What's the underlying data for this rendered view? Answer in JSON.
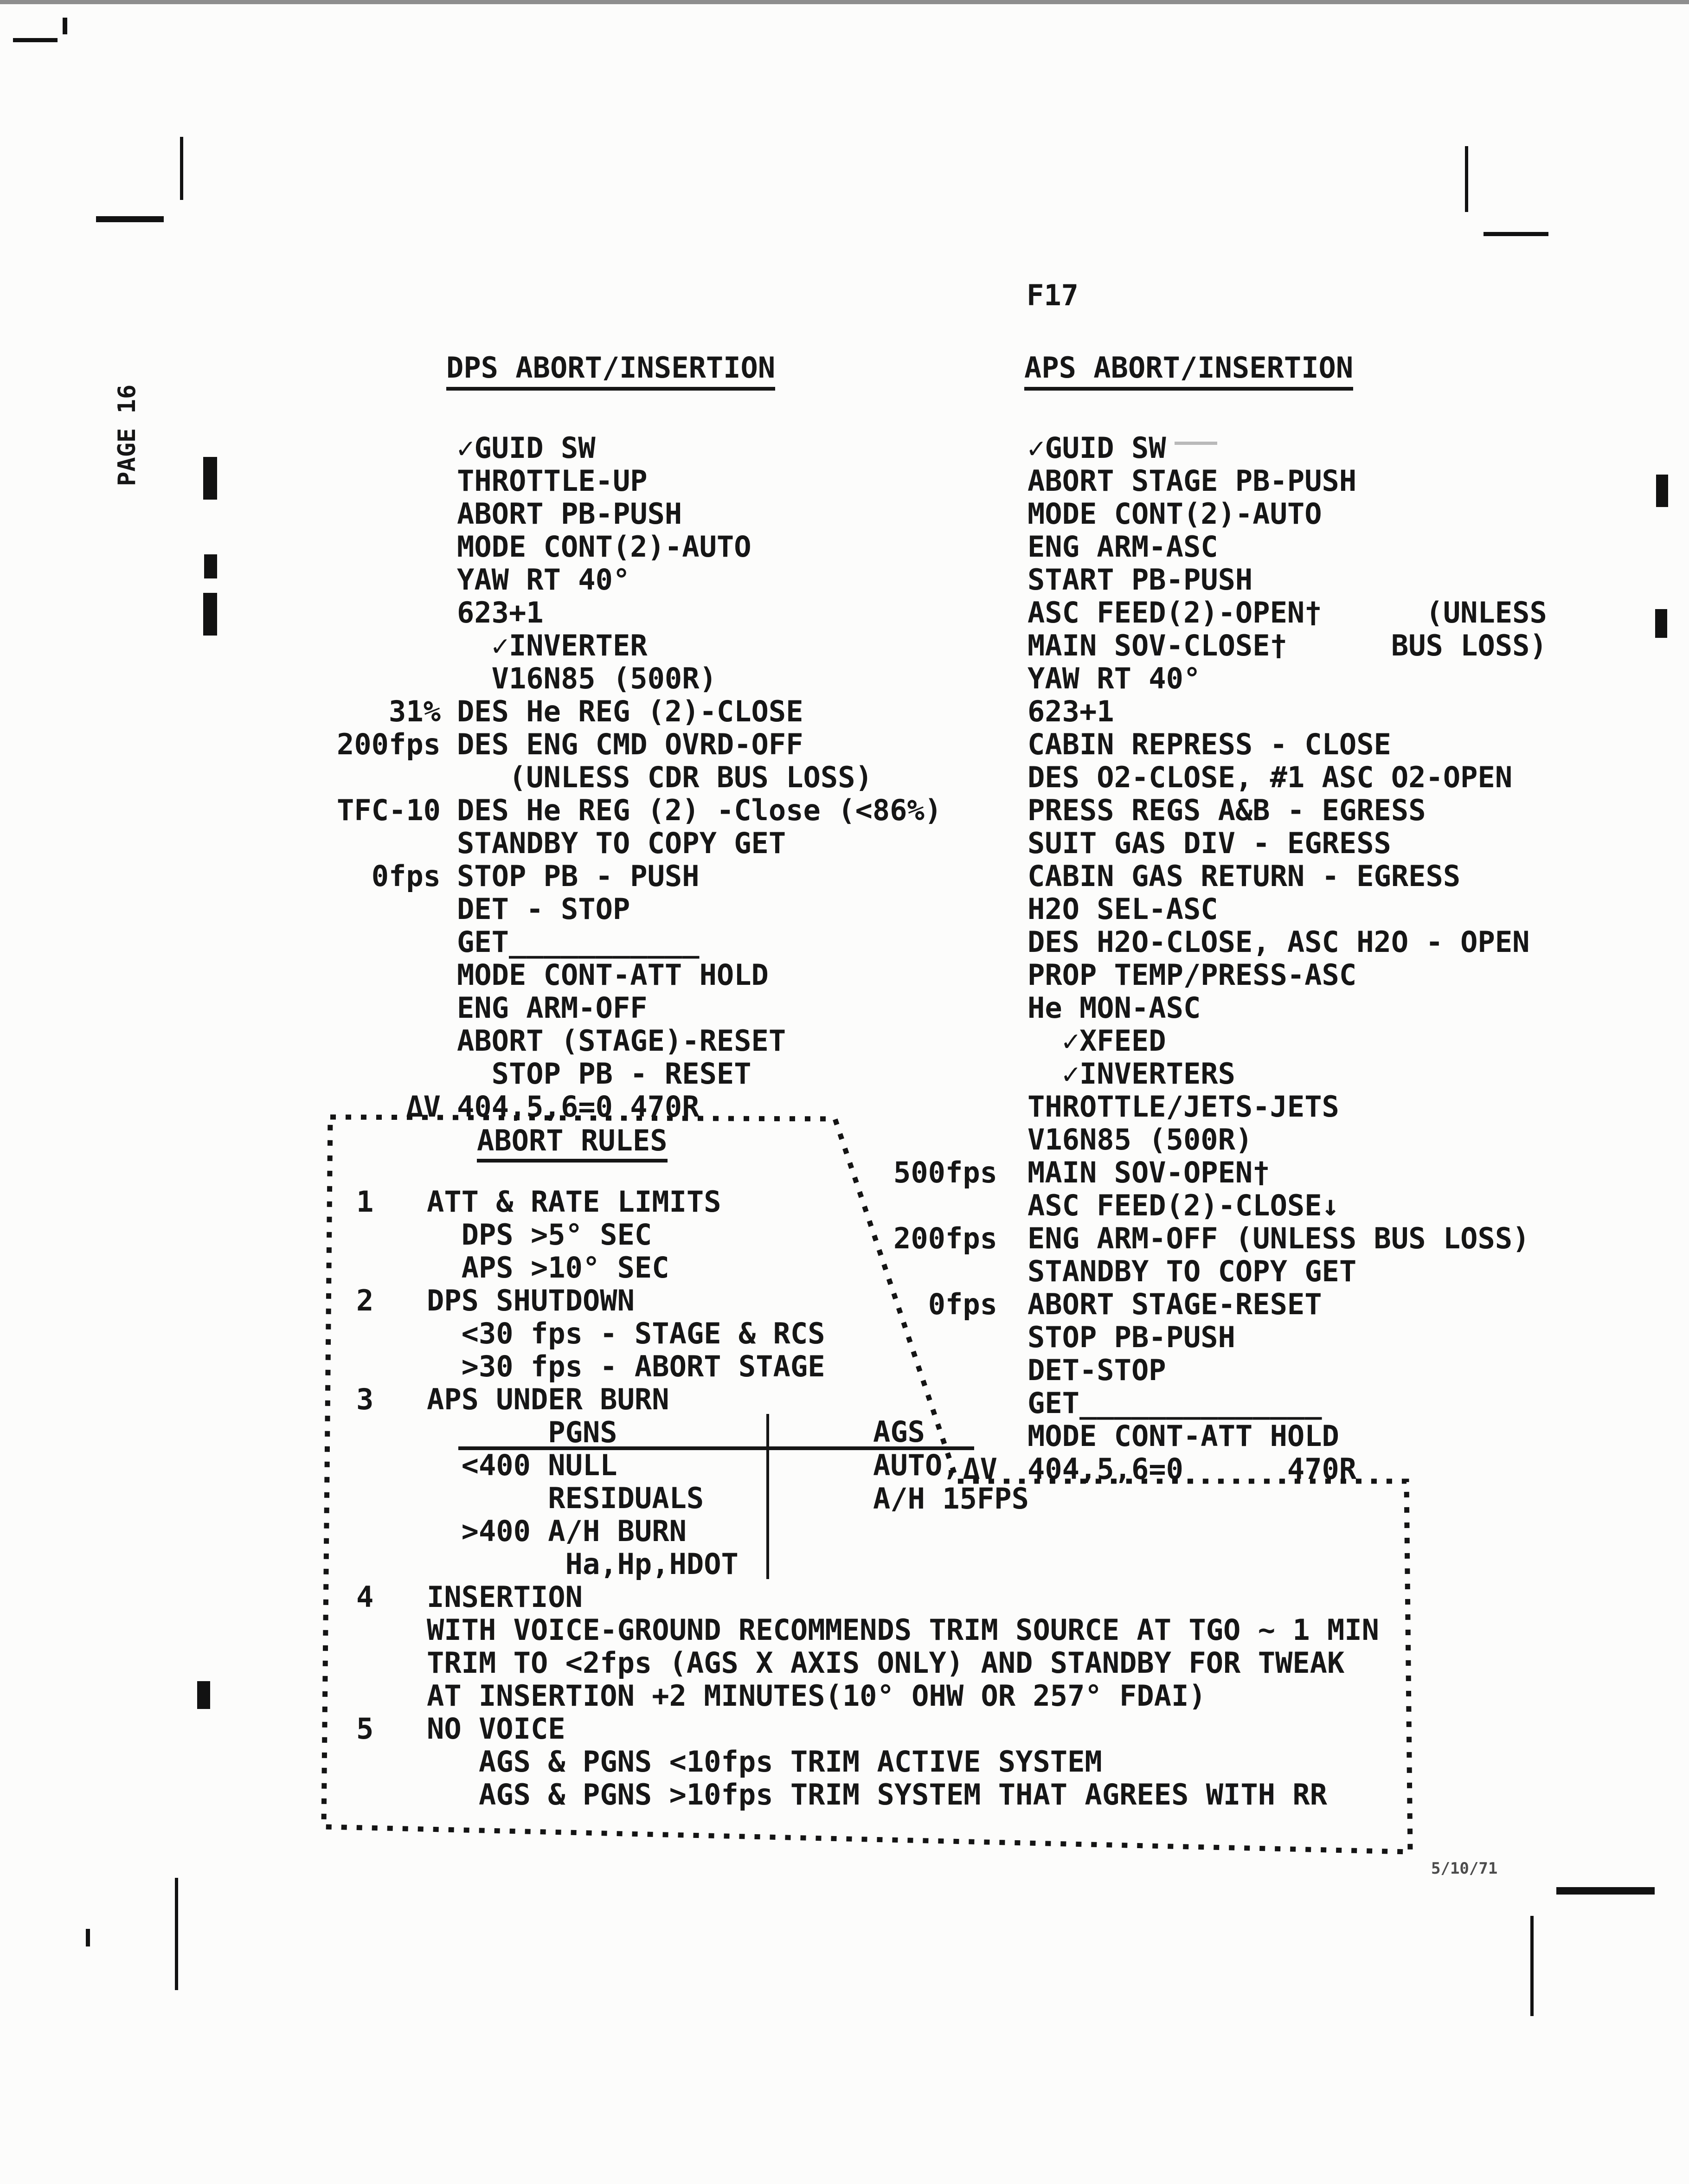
{
  "page": {
    "number_label": "F17",
    "side_label": "PAGE 16",
    "date": "5/10/71"
  },
  "dps": {
    "title": "DPS ABORT/INSERTION",
    "lines": [
      {
        "m": "",
        "t": "✓GUID SW"
      },
      {
        "m": "",
        "t": "THROTTLE-UP"
      },
      {
        "m": "",
        "t": "ABORT PB-PUSH"
      },
      {
        "m": "",
        "t": "MODE CONT(2)-AUTO"
      },
      {
        "m": "",
        "t": "YAW RT 40°"
      },
      {
        "m": "",
        "t": "623+1"
      },
      {
        "m": "",
        "t": "  ✓INVERTER"
      },
      {
        "m": "",
        "t": "  V16N85 (500R)"
      },
      {
        "m": "31%",
        "t": "DES He REG (2)-CLOSE"
      },
      {
        "m": "200fps",
        "t": "DES ENG CMD OVRD-OFF"
      },
      {
        "m": "",
        "t": "   (UNLESS CDR BUS LOSS)"
      },
      {
        "m": "TFC-10",
        "t": "DES He REG (2) -Close (<86%)"
      },
      {
        "m": "",
        "t": "STANDBY TO COPY GET"
      },
      {
        "m": "0fps",
        "t": "STOP PB - PUSH"
      },
      {
        "m": "",
        "t": "DET - STOP"
      },
      {
        "m": "",
        "t": "GET___________"
      },
      {
        "m": "",
        "t": "MODE CONT-ATT HOLD"
      },
      {
        "m": "",
        "t": "ENG ARM-OFF"
      },
      {
        "m": "",
        "t": "ABORT (STAGE)-RESET"
      },
      {
        "m": "",
        "t": "  STOP PB - RESET"
      },
      {
        "m": "ΔV",
        "t": "404,5,6=0 470R"
      }
    ]
  },
  "aps": {
    "title": "APS ABORT/INSERTION",
    "lines": [
      {
        "m": "",
        "t": "✓GUID SW"
      },
      {
        "m": "",
        "t": "ABORT STAGE PB-PUSH"
      },
      {
        "m": "",
        "t": "MODE CONT(2)-AUTO"
      },
      {
        "m": "",
        "t": "ENG ARM-ASC"
      },
      {
        "m": "",
        "t": "START PB-PUSH"
      },
      {
        "m": "",
        "t": "ASC FEED(2)-OPEN†      (UNLESS"
      },
      {
        "m": "",
        "t": "MAIN SOV-CLOSE†      BUS LOSS)"
      },
      {
        "m": "",
        "t": "YAW RT 40°"
      },
      {
        "m": "",
        "t": "623+1"
      },
      {
        "m": "",
        "t": "CABIN REPRESS - CLOSE"
      },
      {
        "m": "",
        "t": "DES O2-CLOSE, #1 ASC O2-OPEN"
      },
      {
        "m": "",
        "t": "PRESS REGS A&B - EGRESS"
      },
      {
        "m": "",
        "t": "SUIT GAS DIV - EGRESS"
      },
      {
        "m": "",
        "t": "CABIN GAS RETURN - EGRESS"
      },
      {
        "m": "",
        "t": "H2O SEL-ASC"
      },
      {
        "m": "",
        "t": "DES H2O-CLOSE, ASC H2O - OPEN"
      },
      {
        "m": "",
        "t": "PROP TEMP/PRESS-ASC"
      },
      {
        "m": "",
        "t": "He MON-ASC"
      },
      {
        "m": "",
        "t": "  ✓XFEED"
      },
      {
        "m": "",
        "t": "  ✓INVERTERS"
      },
      {
        "m": "",
        "t": "THROTTLE/JETS-JETS"
      },
      {
        "m": "",
        "t": "V16N85 (500R)"
      },
      {
        "m": "500fps",
        "t": "MAIN SOV-OPEN†"
      },
      {
        "m": "",
        "t": "ASC FEED(2)-CLOSE↓"
      },
      {
        "m": "200fps",
        "t": "ENG ARM-OFF (UNLESS BUS LOSS)"
      },
      {
        "m": "",
        "t": "STANDBY TO COPY GET"
      },
      {
        "m": "0fps",
        "t": "ABORT STAGE-RESET"
      },
      {
        "m": "",
        "t": "STOP PB-PUSH"
      },
      {
        "m": "",
        "t": "DET-STOP"
      },
      {
        "m": "",
        "t": "GET______________"
      },
      {
        "m": "",
        "t": "MODE CONT-ATT HOLD"
      },
      {
        "m": "ΔV",
        "t": "404,5,6=0      470R"
      }
    ]
  },
  "abort_rules": {
    "title": "ABORT RULES",
    "lines": [
      {
        "n": "1",
        "t": "ATT & RATE LIMITS"
      },
      {
        "n": "",
        "t": "  DPS >5° SEC"
      },
      {
        "n": "",
        "t": "  APS >10° SEC"
      },
      {
        "n": "2",
        "t": "DPS SHUTDOWN"
      },
      {
        "n": "",
        "t": "  <30 fps - STAGE & RCS"
      },
      {
        "n": "",
        "t": "  >30 fps - ABORT STAGE"
      },
      {
        "n": "3",
        "t": "APS UNDER BURN"
      },
      {
        "n": "",
        "t": "       PGNS"
      },
      {
        "n": "",
        "t": "  <400 NULL"
      },
      {
        "n": "",
        "t": "       RESIDUALS"
      },
      {
        "n": "",
        "t": "  >400 A/H BURN"
      },
      {
        "n": "",
        "t": "        Ha,Hp,HDOT"
      },
      {
        "n": "4",
        "t": "INSERTION"
      },
      {
        "n": "",
        "t": "WITH VOICE-GROUND RECOMMENDS TRIM SOURCE AT TGO ~ 1 MIN"
      },
      {
        "n": "",
        "t": "TRIM TO <2fps (AGS X AXIS ONLY) AND STANDBY FOR TWEAK"
      },
      {
        "n": "",
        "t": "AT INSERTION +2 MINUTES(10° OHW OR 257° FDAI)"
      },
      {
        "n": "5",
        "t": "NO VOICE"
      },
      {
        "n": "",
        "t": "   AGS & PGNS <10fps TRIM ACTIVE SYSTEM"
      },
      {
        "n": "",
        "t": "   AGS & PGNS >10fps TRIM SYSTEM THAT AGREES WITH RR"
      }
    ],
    "table": {
      "left_header": "PGNS",
      "right_header": "AGS",
      "right_rows": [
        "AUTO,",
        "A/H 15FPS"
      ]
    }
  }
}
